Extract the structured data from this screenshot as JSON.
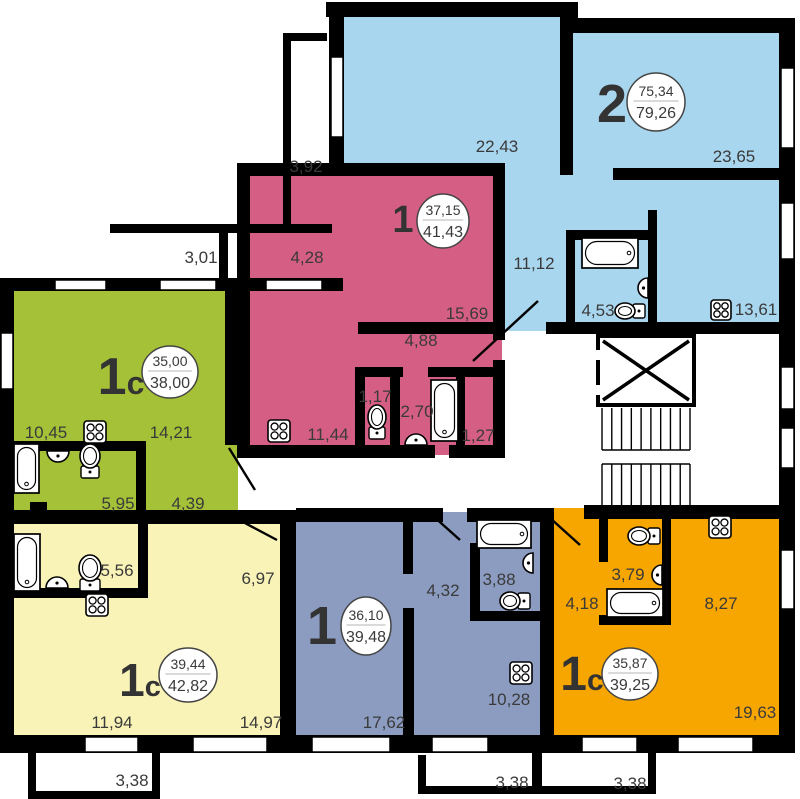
{
  "canvas": {
    "w": 800,
    "h": 799,
    "bg": "#ffffff",
    "wall_color": "#000000",
    "text_color": "#3a3a3a",
    "badge_stroke": "#444444",
    "divider_color": "#b5b5b5"
  },
  "apartments": [
    {
      "id": "apt-2room-blue",
      "type_label": "2",
      "area_living": "75,34",
      "area_total": "79,26",
      "color": "#a9d6ef",
      "rects": [
        [
          332,
          15,
          246,
          316
        ],
        [
          560,
          26,
          231,
          305
        ]
      ],
      "badge": {
        "cx": 656,
        "cy": 102,
        "rx": 29,
        "ry": 29,
        "nx": 612,
        "nb": 122,
        "nf": 54,
        "nf2": 0
      }
    },
    {
      "id": "apt-1room-pink",
      "type_label": "1",
      "area_living": "37,15",
      "area_total": "41,43",
      "color": "#d55e84",
      "rects": [
        [
          240,
          165,
          262,
          290
        ]
      ],
      "badge": {
        "cx": 443,
        "cy": 221,
        "rx": 26,
        "ry": 27,
        "nx": 403,
        "nb": 232,
        "nf": 38,
        "nf2": 0
      }
    },
    {
      "id": "apt-1c-green",
      "type_label": "1с",
      "area_living": "35,00",
      "area_total": "38,00",
      "color": "#a5c138",
      "rects": [
        [
          10,
          282,
          228,
          236
        ]
      ],
      "badge": {
        "cx": 170,
        "cy": 372,
        "rx": 28,
        "ry": 26,
        "nx": 121,
        "nb": 394,
        "nf": 52,
        "nf2": 32
      }
    },
    {
      "id": "apt-1c-yellow",
      "type_label": "1с",
      "area_living": "39,44",
      "area_total": "42,82",
      "color": "#faf3b8",
      "rects": [
        [
          10,
          512,
          276,
          228
        ]
      ],
      "badge": {
        "cx": 188,
        "cy": 675,
        "rx": 29,
        "ry": 27,
        "nx": 140,
        "nb": 696,
        "nf": 46,
        "nf2": 29
      }
    },
    {
      "id": "apt-1room-slate",
      "type_label": "1",
      "area_living": "36,10",
      "area_total": "39,48",
      "color": "#8c9cc1",
      "rects": [
        [
          286,
          512,
          262,
          228
        ]
      ],
      "badge": {
        "cx": 366,
        "cy": 626,
        "rx": 25,
        "ry": 29,
        "nx": 322,
        "nb": 644,
        "nf": 54,
        "nf2": 0
      }
    },
    {
      "id": "apt-1c-orange",
      "type_label": "1с",
      "area_living": "35,87",
      "area_total": "39,25",
      "color": "#f7a600",
      "rects": [
        [
          548,
          508,
          243,
          232
        ]
      ],
      "badge": {
        "cx": 630,
        "cy": 674,
        "rx": 28,
        "ry": 26,
        "nx": 582,
        "nb": 690,
        "nf": 48,
        "nf2": 30
      }
    }
  ],
  "walls": [
    [
      326,
      2,
      252,
      15
    ],
    [
      560,
      2,
      18,
      31
    ],
    [
      560,
      18,
      235,
      15
    ],
    [
      779,
      18,
      16,
      722
    ],
    [
      0,
      735,
      795,
      18
    ],
    [
      0,
      278,
      14,
      475
    ],
    [
      329,
      17,
      15,
      150
    ],
    [
      560,
      17,
      13,
      158
    ],
    [
      237,
      163,
      268,
      13
    ],
    [
      613,
      168,
      166,
      12
    ],
    [
      358,
      322,
      140,
      12
    ],
    [
      546,
      322,
      249,
      12
    ],
    [
      566,
      230,
      9,
      95
    ],
    [
      566,
      230,
      89,
      10
    ],
    [
      648,
      210,
      9,
      115
    ],
    [
      237,
      163,
      13,
      295
    ],
    [
      493,
      175,
      12,
      165
    ],
    [
      493,
      360,
      12,
      98
    ],
    [
      237,
      445,
      198,
      13
    ],
    [
      449,
      445,
      56,
      13
    ],
    [
      355,
      367,
      48,
      10
    ],
    [
      428,
      367,
      77,
      10
    ],
    [
      355,
      367,
      10,
      78
    ],
    [
      390,
      377,
      10,
      68
    ],
    [
      456,
      377,
      9,
      68
    ],
    [
      0,
      278,
      343,
      13
    ],
    [
      225,
      288,
      12,
      157
    ],
    [
      13,
      441,
      126,
      10
    ],
    [
      136,
      441,
      10,
      72
    ],
    [
      30,
      502,
      17,
      11
    ],
    [
      0,
      510,
      296,
      14
    ],
    [
      296,
      508,
      147,
      14
    ],
    [
      467,
      508,
      87,
      14
    ],
    [
      280,
      510,
      16,
      243
    ],
    [
      540,
      508,
      14,
      245
    ],
    [
      403,
      516,
      10,
      58
    ],
    [
      403,
      608,
      11,
      130
    ],
    [
      470,
      543,
      10,
      74
    ],
    [
      470,
      611,
      84,
      10
    ],
    [
      584,
      505,
      195,
      14
    ],
    [
      599,
      505,
      9,
      57
    ],
    [
      662,
      505,
      9,
      120
    ],
    [
      599,
      615,
      72,
      10
    ],
    [
      13,
      588,
      127,
      10
    ],
    [
      138,
      518,
      10,
      80
    ]
  ],
  "thin_walls": [
    [
      283,
      33,
      8,
      200
    ],
    [
      283,
      33,
      44,
      8
    ],
    [
      110,
      224,
      222,
      9
    ],
    [
      219,
      230,
      9,
      58
    ],
    [
      28,
      753,
      8,
      45
    ],
    [
      28,
      791,
      132,
      8
    ],
    [
      152,
      753,
      8,
      45
    ],
    [
      418,
      755,
      8,
      35
    ],
    [
      418,
      786,
      122,
      8
    ],
    [
      532,
      753,
      10,
      41
    ],
    [
      542,
      786,
      114,
      8
    ],
    [
      648,
      753,
      8,
      41
    ]
  ],
  "windows": [
    [
      331,
      57,
      12,
      80
    ],
    [
      781,
      68,
      13,
      80
    ],
    [
      781,
      203,
      13,
      56
    ],
    [
      781,
      367,
      13,
      42
    ],
    [
      781,
      428,
      13,
      40
    ],
    [
      781,
      550,
      13,
      59
    ],
    [
      55,
      280,
      51,
      10
    ],
    [
      160,
      280,
      56,
      10
    ],
    [
      266,
      280,
      56,
      10
    ],
    [
      1,
      333,
      12,
      56
    ],
    [
      85,
      737,
      53,
      15
    ],
    [
      193,
      737,
      74,
      15
    ],
    [
      312,
      737,
      78,
      15
    ],
    [
      432,
      737,
      56,
      15
    ],
    [
      582,
      737,
      55,
      15
    ],
    [
      678,
      737,
      75,
      15
    ]
  ],
  "door_lines": [
    [
      473,
      361,
      538,
      301
    ],
    [
      229,
      448,
      255,
      490
    ],
    [
      243,
      522,
      277,
      540
    ],
    [
      432,
      515,
      460,
      540
    ],
    [
      550,
      518,
      580,
      545
    ]
  ],
  "dim_labels": [
    {
      "t": "3,92",
      "x": 306,
      "y": 166
    },
    {
      "t": "3,01",
      "x": 201,
      "y": 257
    },
    {
      "t": "4,28",
      "x": 307,
      "y": 257
    },
    {
      "t": "22,43",
      "x": 497,
      "y": 146
    },
    {
      "t": "23,65",
      "x": 734,
      "y": 156
    },
    {
      "t": "11,12",
      "x": 534,
      "y": 263
    },
    {
      "t": "4,53",
      "x": 598,
      "y": 310
    },
    {
      "t": "13,61",
      "x": 756,
      "y": 309
    },
    {
      "t": "15,69",
      "x": 467,
      "y": 313
    },
    {
      "t": "4,88",
      "x": 421,
      "y": 340
    },
    {
      "t": "1,17",
      "x": 375,
      "y": 396
    },
    {
      "t": "2,70",
      "x": 417,
      "y": 411
    },
    {
      "t": "11,44",
      "x": 328,
      "y": 434
    },
    {
      "t": "1,27",
      "x": 478,
      "y": 435
    },
    {
      "t": "10,45",
      "x": 46,
      "y": 432
    },
    {
      "t": "14,21",
      "x": 171,
      "y": 432
    },
    {
      "t": "5,95",
      "x": 118,
      "y": 503
    },
    {
      "t": "4,39",
      "x": 188,
      "y": 503
    },
    {
      "t": "5,56",
      "x": 117,
      "y": 570
    },
    {
      "t": "6,97",
      "x": 258,
      "y": 578
    },
    {
      "t": "11,94",
      "x": 112,
      "y": 722
    },
    {
      "t": "14,97",
      "x": 261,
      "y": 722
    },
    {
      "t": "17,62",
      "x": 384,
      "y": 722
    },
    {
      "t": "4,32",
      "x": 443,
      "y": 590
    },
    {
      "t": "3,88",
      "x": 499,
      "y": 579
    },
    {
      "t": "10,28",
      "x": 509,
      "y": 699
    },
    {
      "t": "3,79",
      "x": 628,
      "y": 574
    },
    {
      "t": "4,18",
      "x": 582,
      "y": 603
    },
    {
      "t": "8,27",
      "x": 721,
      "y": 603
    },
    {
      "t": "19,63",
      "x": 755,
      "y": 712
    },
    {
      "t": "3,38",
      "x": 132,
      "y": 780
    },
    {
      "t": "3,38",
      "x": 512,
      "y": 782
    },
    {
      "t": "3,38",
      "x": 630,
      "y": 783
    }
  ],
  "stoves": [
    [
      84,
      421,
      22
    ],
    [
      268,
      420,
      22
    ],
    [
      86,
      594,
      22
    ],
    [
      711,
      300,
      20
    ],
    [
      510,
      662,
      22
    ],
    [
      709,
      516,
      22
    ]
  ],
  "tubs": [
    [
      582,
      238,
      56,
      30
    ],
    [
      431,
      380,
      27,
      61
    ],
    [
      14,
      444,
      25,
      49
    ],
    [
      14,
      534,
      26,
      57
    ],
    [
      477,
      520,
      54,
      28
    ],
    [
      607,
      589,
      56,
      28
    ]
  ],
  "sinks": [
    [
      58,
      451,
      11,
      "top"
    ],
    [
      57,
      588,
      11,
      "bottom"
    ],
    [
      416,
      445,
      11,
      "bottom"
    ],
    [
      648,
      288,
      10,
      "right"
    ],
    [
      533,
      563,
      10,
      "right"
    ],
    [
      662,
      575,
      10,
      "right"
    ]
  ],
  "toilets": [
    [
      90,
      456,
      10,
      12,
      "bottom"
    ],
    [
      90,
      568,
      11,
      13,
      "bottom"
    ],
    [
      377,
      417,
      9,
      12,
      "bottom"
    ],
    [
      625,
      311,
      10,
      8,
      "right"
    ],
    [
      510,
      601,
      10,
      9,
      "right"
    ],
    [
      639,
      536,
      11,
      9,
      "right"
    ]
  ],
  "elevator": {
    "x": 600,
    "y": 338,
    "w": 92,
    "h": 65,
    "border": 8,
    "notches": [
      [
        594,
        350,
        9,
        10
      ],
      [
        594,
        385,
        9,
        10
      ]
    ]
  },
  "stairs": {
    "x1": 602,
    "x2": 690,
    "y_top": 408,
    "y_mid1": 450,
    "y_mid2": 464,
    "y_bot": 506,
    "treads": 9
  }
}
